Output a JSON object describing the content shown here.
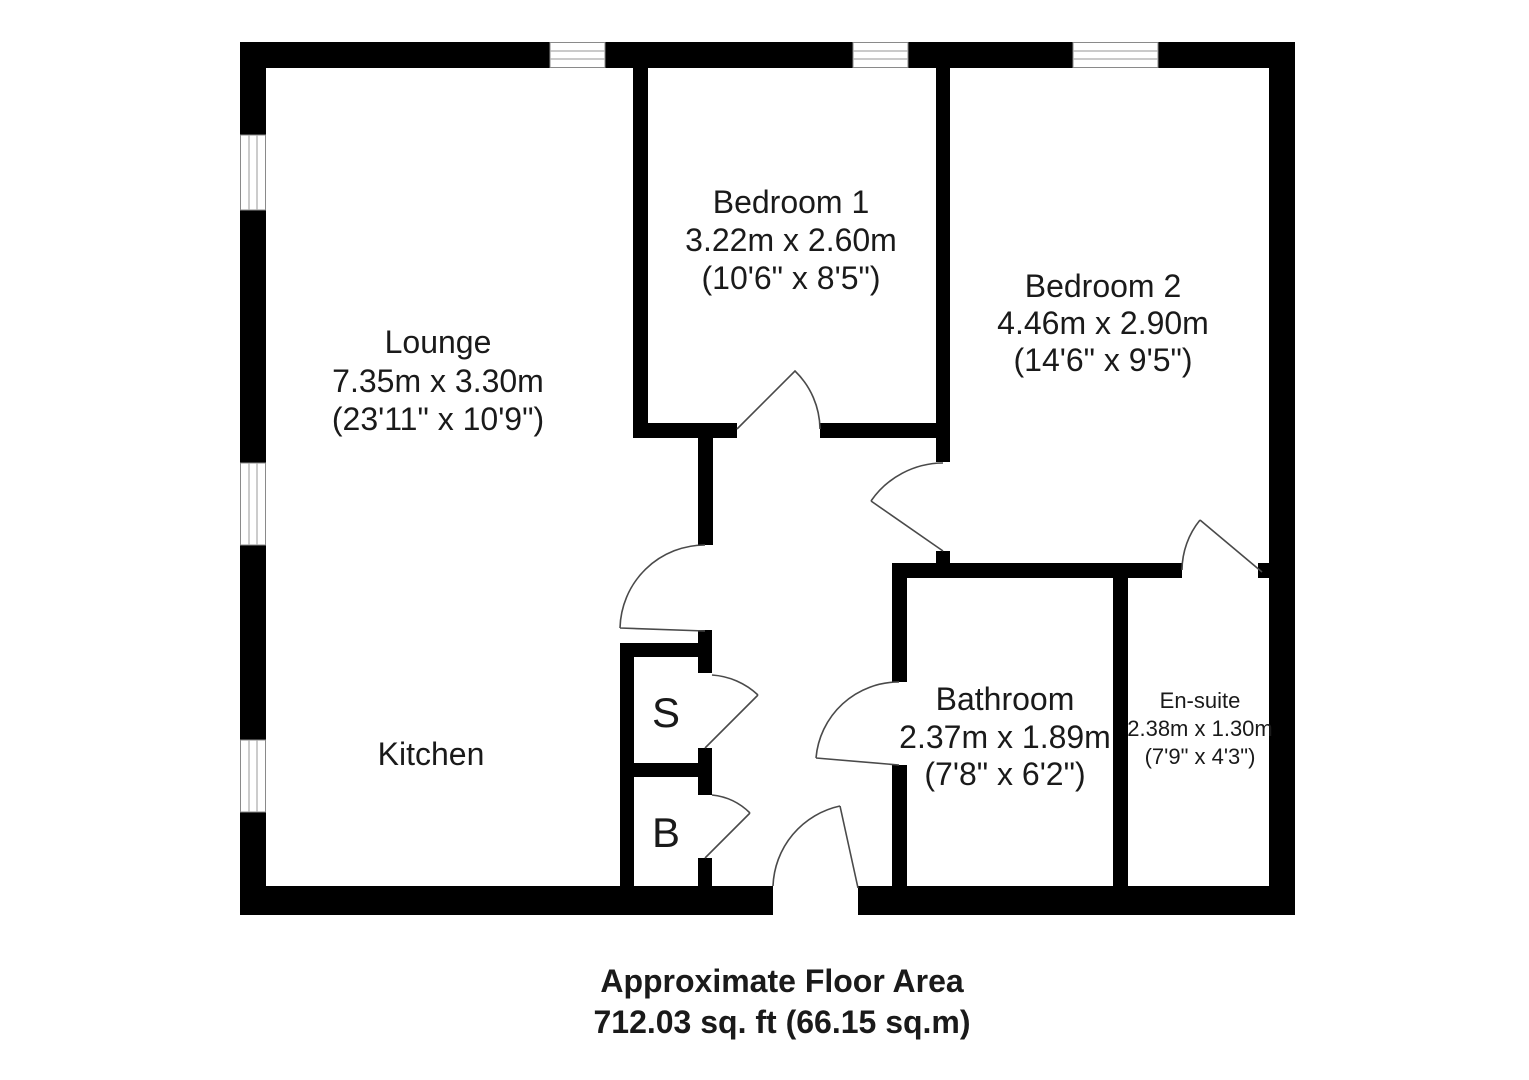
{
  "colors": {
    "wall": "#000000",
    "background": "#ffffff",
    "door_swing": "#4a4a4a",
    "window_frame": "#8a8a8a",
    "text": "#1a1a1a"
  },
  "rooms": {
    "lounge": {
      "name": "Lounge",
      "metric": "7.35m x 3.30m",
      "imperial": "(23'11\" x 10'9\")"
    },
    "kitchen": {
      "name": "Kitchen"
    },
    "bedroom1": {
      "name": "Bedroom 1",
      "metric": "3.22m x 2.60m",
      "imperial": "(10'6\" x 8'5\")"
    },
    "bedroom2": {
      "name": "Bedroom 2",
      "metric": "4.46m x 2.90m",
      "imperial": "(14'6\" x 9'5\")"
    },
    "bathroom": {
      "name": "Bathroom",
      "metric": "2.37m x 1.89m",
      "imperial": "(7'8\" x 6'2\")"
    },
    "ensuite": {
      "name": "En-suite",
      "metric": "2.38m x 1.30m",
      "imperial": "(7'9\" x 4'3\")"
    },
    "cupboard_s": {
      "label": "S"
    },
    "cupboard_b": {
      "label": "B"
    }
  },
  "footer": {
    "title": "Approximate Floor Area",
    "area": "712.03 sq. ft (66.15 sq.m)"
  }
}
